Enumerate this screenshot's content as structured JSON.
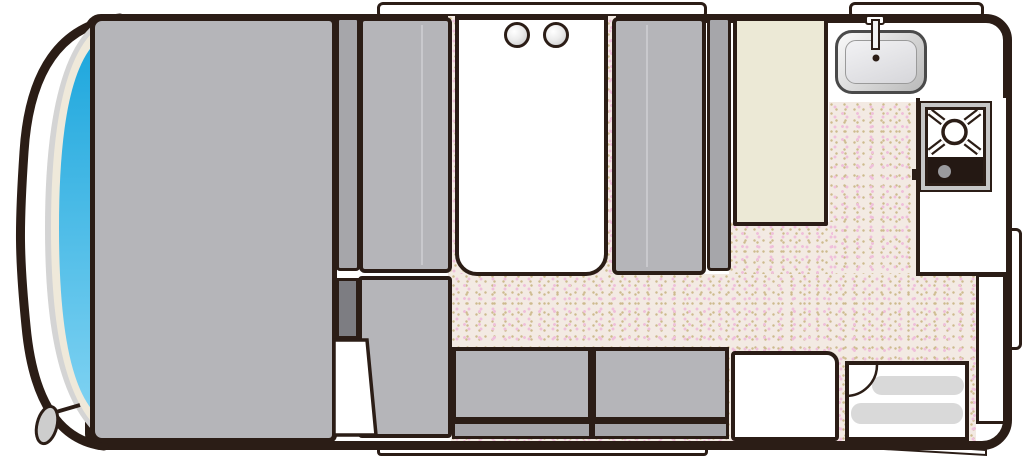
{
  "app": {
    "title": "Camper van floor plan (top view)"
  },
  "colors": {
    "wall": "#2b1d16",
    "furniture-gray": "#b5b5b9",
    "furniture-gray-dark": "#a6a6aa",
    "storage-dark": "#7d7d82",
    "cream": "#ece9d6",
    "floor-base": "#f3eae3",
    "floor-dot-pink": "#efc0db",
    "floor-dot-tan": "#cdbb8e",
    "windshield-top": "#1ea7dd",
    "windshield-bottom": "#7fd2f2",
    "trim-gray": "#d4d4d4",
    "trim-cream": "#efe9da",
    "metal-dark": "#b9b9b9",
    "step-gray": "#d9d9d9",
    "stove-panel": "#241813",
    "knob-gray": "#9a9a9e",
    "mirror-gray": "#cdcdcd"
  },
  "elements": {
    "stage": "Camper van floor plan",
    "vehicle_body": "Vehicle body shell",
    "cab_outline": "Cab front outline",
    "windshield": "Windshield",
    "side_mirror": "Side mirror",
    "bed": "Bed",
    "dinette_left_backrest": "Dinette left backrest cushion",
    "dinette_left_seat": "Dinette left seat",
    "dinette_table": "Dinette table",
    "cup": "Cup holder",
    "dinette_right_seat": "Dinette right seat",
    "dinette_right_backrest": "Dinette right backrest cushion",
    "tall_cabinet": "Tall cabinet / fridge",
    "window_front": "Window (dinette wall)",
    "window_kitchen": "Window (kitchen wall)",
    "window_side": "Window (right wall)",
    "body_skirt": "Lower body skirt / slide-out step",
    "sink": "Kitchen sink",
    "faucet": "Faucet",
    "kitchen_counter": "Kitchen counter",
    "stove": "Gas stove",
    "stove_burner": "Stove burner",
    "stove_control": "Stove control panel",
    "right_cabinet": "Cabinet (right wall)",
    "storage_box": "Storage compartment",
    "lower_cabinet": "Lower cabinet",
    "cabinet_door": "Open cabinet door",
    "sofa_seat_1": "Sofa seat (left)",
    "sofa_seat_2": "Sofa seat (right)",
    "sofa_front": "Sofa seat front",
    "side_table": "Side table",
    "entryway": "Entryway",
    "entry_step": "Entry step",
    "entry_door_swing": "Entry door swing arc",
    "entry_door_open": "Entry door (open, exterior)",
    "floor": "Vinyl floor"
  }
}
